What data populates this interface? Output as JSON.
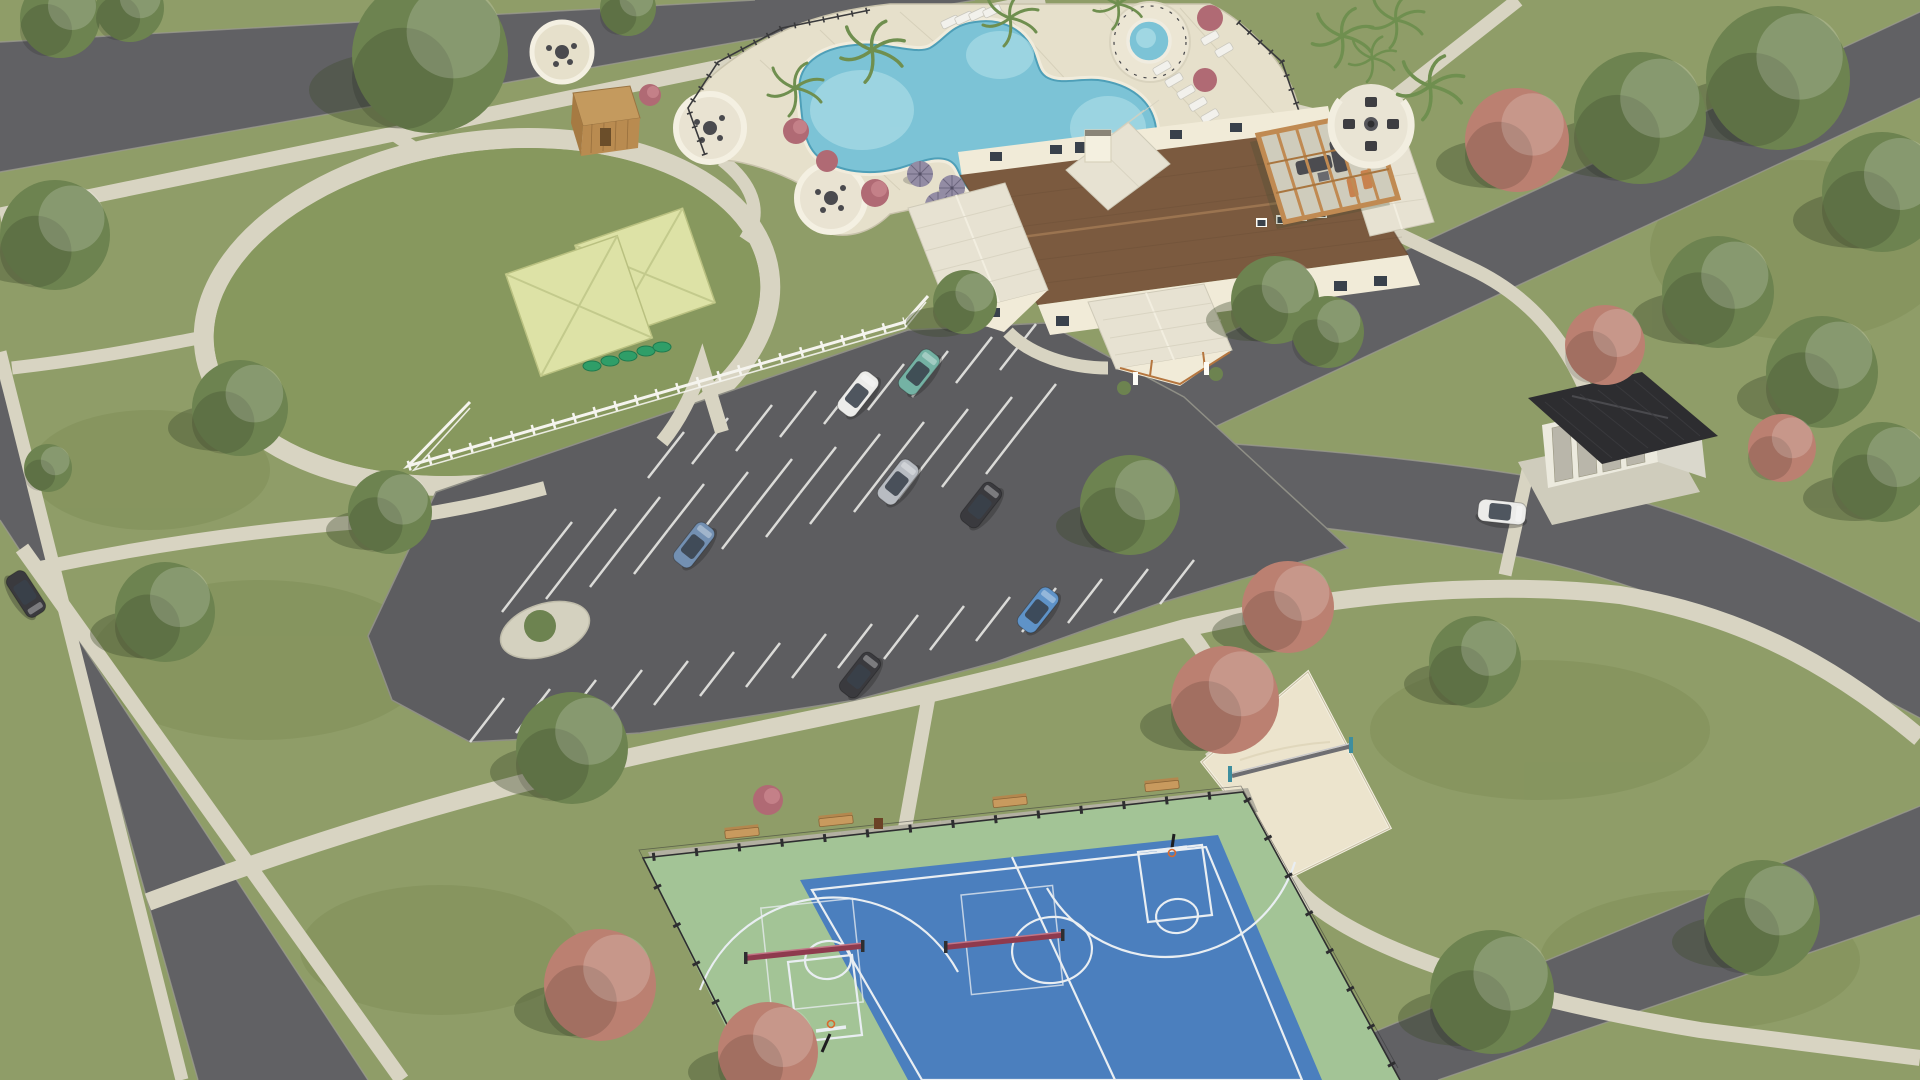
{
  "scene": {
    "type": "aerial-3d-architectural-rendering",
    "subject": "community amenity center site",
    "features": [
      "resort-style freeform swimming pool with spa",
      "pool deck with umbrellas, loungers and circular seating nooks",
      "farmhouse-style clubhouse with brown shingle and white metal roofs",
      "wood pergola lounge and fire-pit lounge",
      "oval event lawn with walking loop",
      "fenced dog park with two shade canopies and agility pods",
      "storage shed",
      "striped parking lot with parked cars",
      "mail kiosk with dark hip roof",
      "blue and green sport court with basketball hoops and pickleball nets",
      "sand volleyball court with net",
      "roads, sidewalks, green and copper trees, palm trees"
    ]
  },
  "inventory": {
    "cars_in_parking_lot": 7,
    "cars_on_roads": 2,
    "shade_canopies": 2,
    "pool_umbrellas": 5,
    "circular_seating_nooks": 3,
    "pickleball_nets": 2,
    "basketball_hoops": 2,
    "benches": 4,
    "pool_loungers": 11,
    "dog_agility_pods": 5
  },
  "palette": {
    "grass": "#8f9d68",
    "lawn": "#87985e",
    "grass_dark": "#75854e",
    "road": "#616164",
    "parking": "#5d5d60",
    "stripe": "#e9e9e5",
    "sidewalk": "#d8d4c2",
    "deck": "#e6e0cb",
    "paver_gray": "#b3b0a2",
    "pool_water": "#7cc3d6",
    "pool_shallow": "#a9dce6",
    "pool_edge": "#4e9fb8",
    "coping": "#f1ecdc",
    "roof_brown": "#7b5a3f",
    "roof_metal": "#e7e2d2",
    "wall_cream": "#f1ebd8",
    "wood": "#c08a52",
    "canopy": "#dde2a6",
    "fence_white": "#f5f4ee",
    "fence_dark": "#2e2e30",
    "court_green": "#a3c496",
    "court_blue": "#4b7fbe",
    "court_line": "#e9eef2",
    "net_maroon": "#8e3a4e",
    "sand": "#ece4cd",
    "kiosk_roof": "#2d2d30",
    "shed_wood": "#c49a5e",
    "tree_green": "#6d8350",
    "tree_green_light": "#869a62",
    "tree_copper": "#bb8071",
    "tree_copper_light": "#d09a8a",
    "shrub_pink": "#b06a74",
    "shadow": "#3e4b2e",
    "umbrella": "#938ca4",
    "car_white": "#ececea",
    "car_teal": "#74b2a4",
    "car_gray": "#b8bcc2",
    "car_dark": "#3a3a3e",
    "car_steel": "#7390b2",
    "car_blue": "#5f93c8"
  }
}
